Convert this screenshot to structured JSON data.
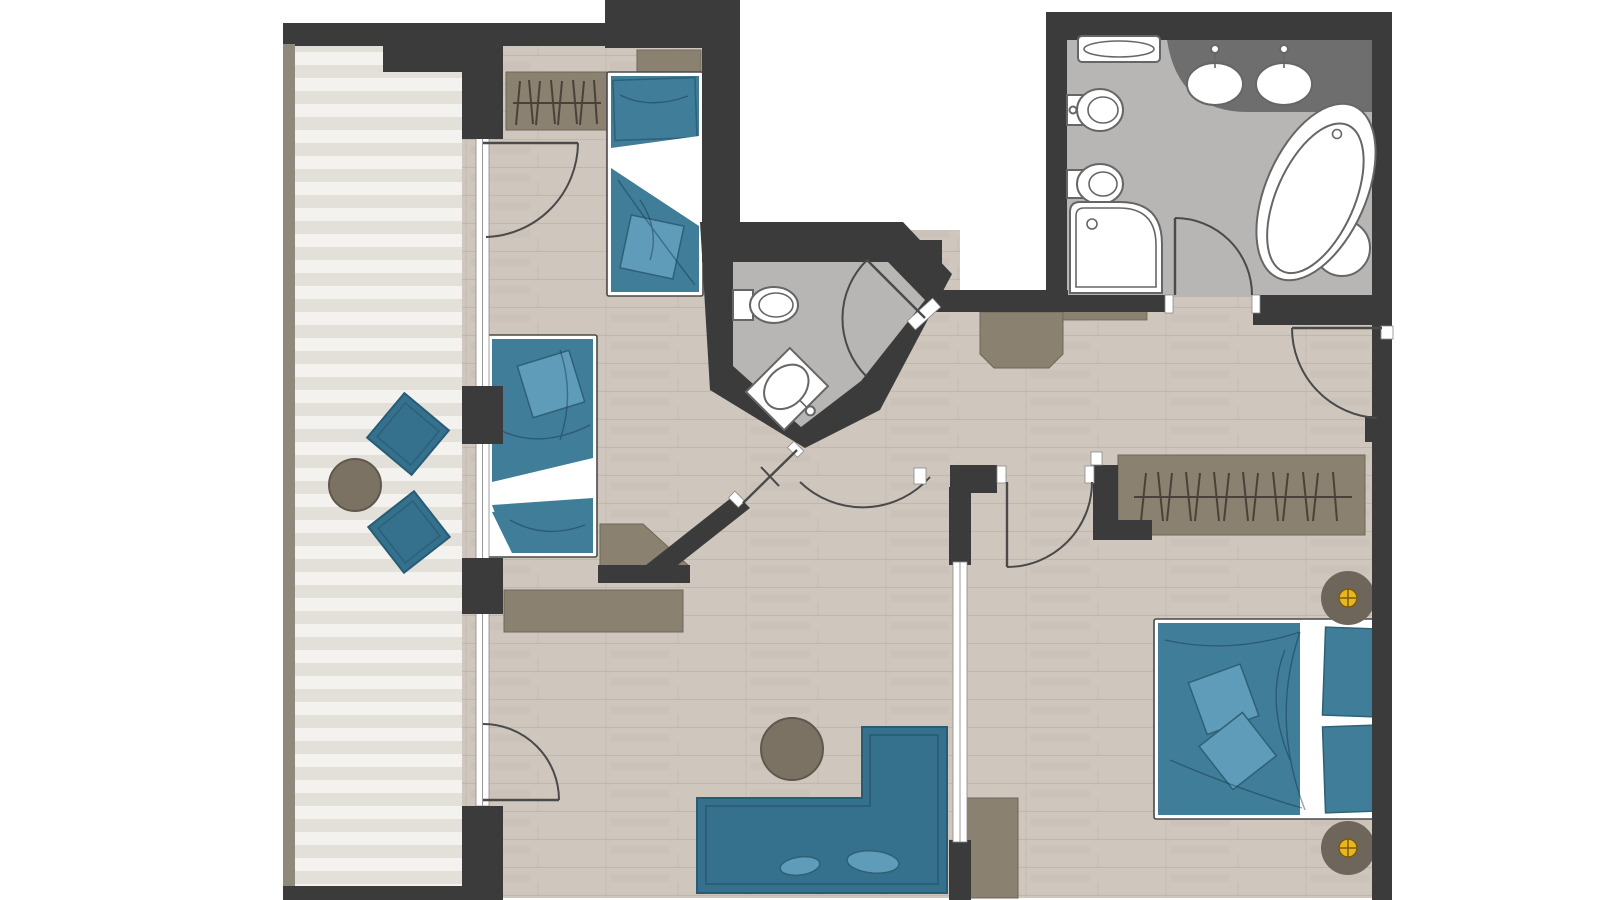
{
  "colors": {
    "page_bg": "#ffffff",
    "wall": "#3b3b3b",
    "wall_tan": "#8f897c",
    "floor_wood": "#cfc7bd",
    "floor_wood_line": "#b3a99d",
    "deck_light": "#f3f2ee",
    "deck_dark": "#e3e0d9",
    "tile": "#b7b6b4",
    "counter": "#6e6e6e",
    "furn_teal": "#35708c",
    "furn_teal_dark": "#265d74",
    "bed_teal": "#3f7d99",
    "bed_teal_dark": "#2e6076",
    "pillow_teal": "#5e9cba",
    "furn_brown": "#8b8171",
    "furn_brown_dark": "#5f574b",
    "hanger": "#4a4238",
    "table_brown": "#7b7264",
    "table_brown_dark": "#60584c",
    "side_table": "#6e665b",
    "flower_yellow": "#eab61e",
    "flower_outline": "#7a5c0e",
    "door_arc": "#4a4a4a",
    "fixture_stroke": "#666666",
    "glass_line": "#9a9a9a"
  },
  "plan": {
    "balcony": {
      "chairs": 2,
      "round_tables": 1
    },
    "bedroom_top_left": {
      "single_beds": 2,
      "wardrobes": 1,
      "sideboards": 2
    },
    "wc": {
      "toilets": 1,
      "corner_sinks": 1
    },
    "bathroom": {
      "sinks": 2,
      "bathtubs": 1,
      "showers": 1,
      "toilets": 1,
      "bidets": 1,
      "shelves": 1
    },
    "bedroom_right": {
      "double_beds": 1,
      "wardrobes": 1,
      "bedside_tables": 2,
      "tv_cabinets": 1
    },
    "living_area": {
      "corner_sofas": 1,
      "coffee_tables": 1,
      "sideboards": 1
    },
    "doors_with_swing_arcs": 7,
    "glass_partitions": 1
  }
}
